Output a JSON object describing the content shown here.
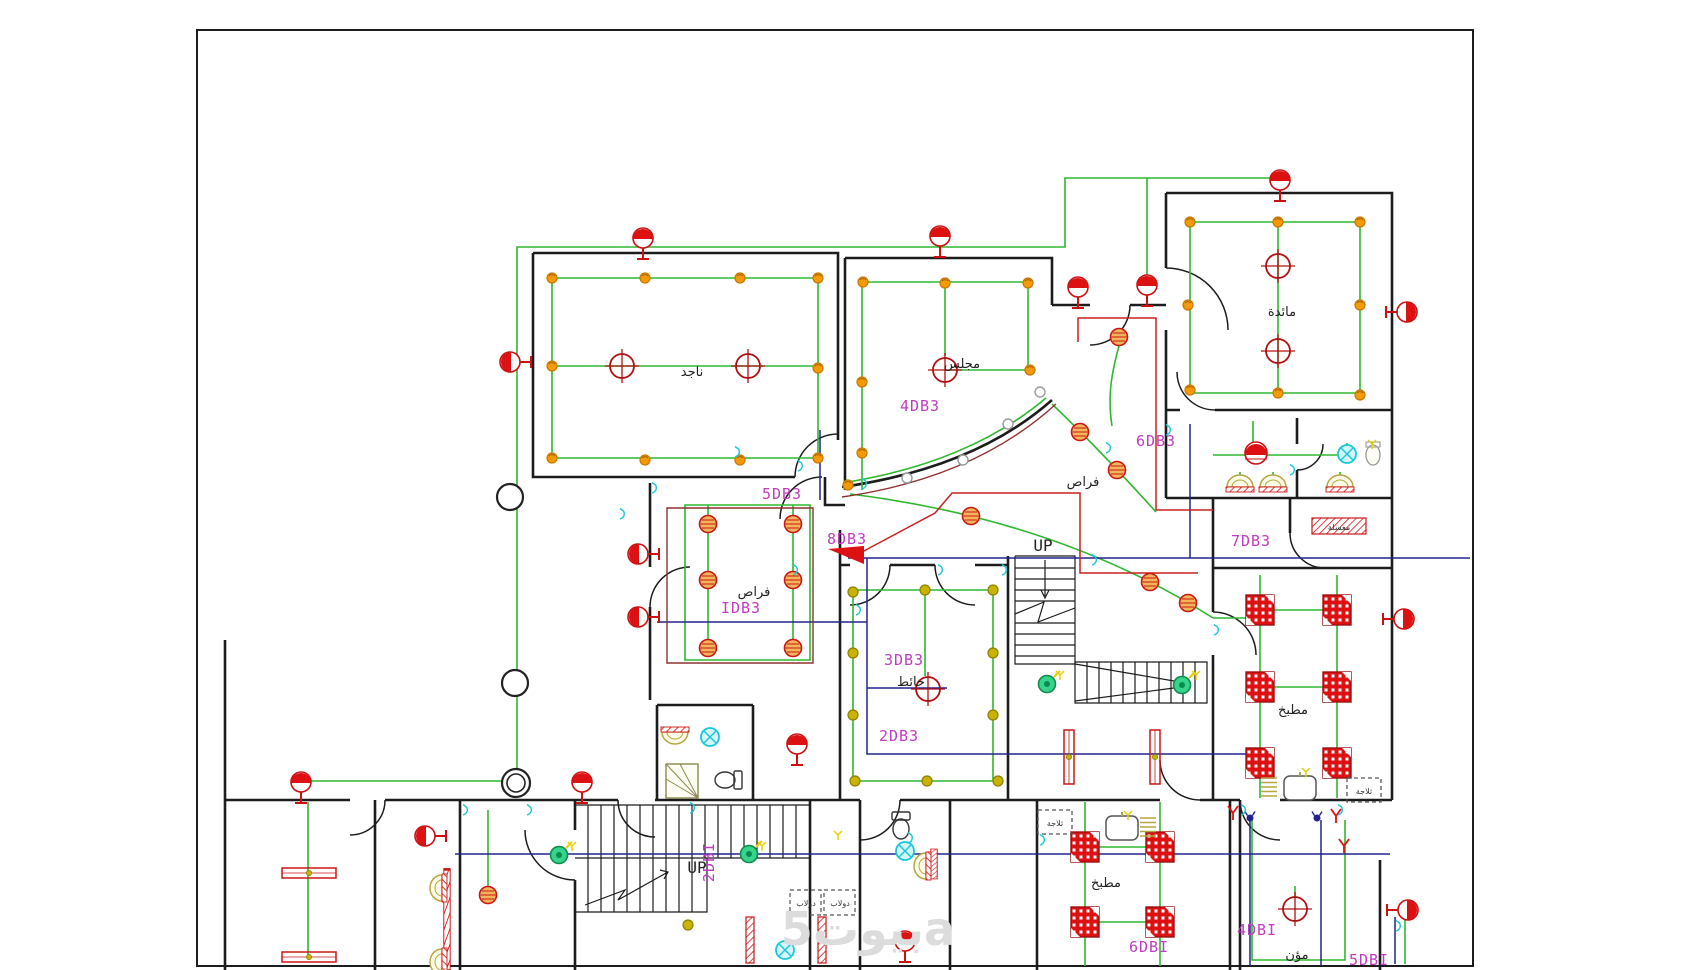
{
  "drawing": {
    "type": "electrical-floor-plan",
    "watermark": "بيوت5a",
    "colors": {
      "wall": "#1c1c1c",
      "wiring_green": "#2eb82e",
      "circuit_navy": "#23238f",
      "circuit_red": "#cc2020",
      "circuit_maroon": "#8f3030",
      "symbol_red": "#dd1111",
      "ceiling_spot_orange": "#f59a00",
      "ceiling_spot_olive": "#c8b400",
      "label_magenta": "#c03cc0",
      "fixture_cyan": "#18c8dc",
      "fan_green": "#35d488",
      "watermark_gray": "#dcdcdc"
    },
    "labels": {
      "panels": [
        {
          "text": "5DB3"
        },
        {
          "text": "4DB3"
        },
        {
          "text": "6DB3"
        },
        {
          "text": "7DB3"
        },
        {
          "text": "8DB3"
        },
        {
          "text": "IDB3"
        },
        {
          "text": "3DB3"
        },
        {
          "text": "2DB3"
        },
        {
          "text": "2DBI"
        },
        {
          "text": "6DBI"
        },
        {
          "text": "4DBI"
        },
        {
          "text": "5DBI"
        }
      ],
      "stairs_up": [
        {
          "text": "UP"
        },
        {
          "text": "UP"
        }
      ],
      "rooms": [
        {
          "text": "ناجد"
        },
        {
          "text": "مجلس"
        },
        {
          "text": "مائدة"
        },
        {
          "text": "فراص"
        },
        {
          "text": "فراص"
        },
        {
          "text": "حائط"
        },
        {
          "text": "مطبخ"
        },
        {
          "text": "مطبخ"
        },
        {
          "text": "مؤن"
        },
        {
          "text": "ثلاجة"
        },
        {
          "text": "ثلاجة"
        },
        {
          "text": "دولاب"
        },
        {
          "text": "دولاب"
        },
        {
          "text": "مغسلة"
        }
      ]
    }
  }
}
